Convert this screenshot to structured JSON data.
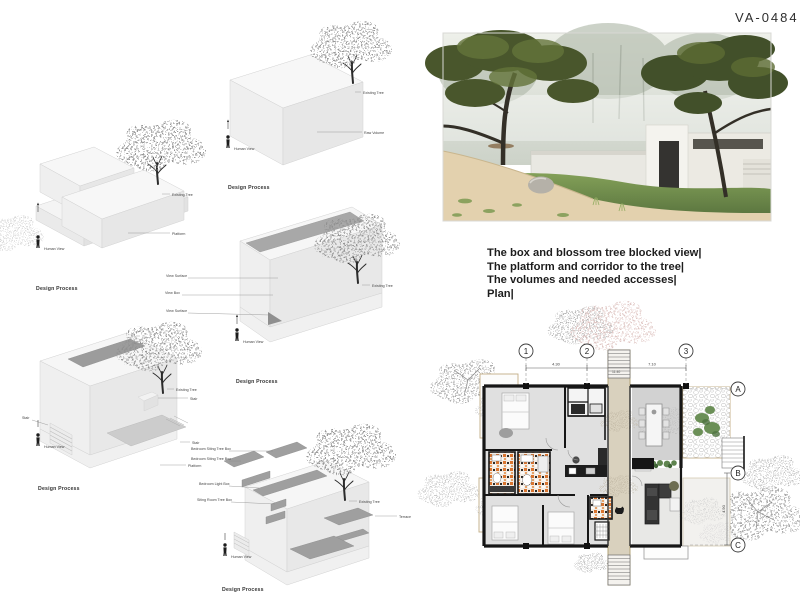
{
  "board": {
    "code": "VA-0484"
  },
  "description": {
    "line1": "The box and blossom tree blocked view|",
    "line2": "The platform and corridor to the tree|",
    "line3": "The volumes and needed accesses|",
    "line4": "Plan|"
  },
  "diagrams": {
    "caption": "Design Process",
    "d1": {
      "labels": {
        "existing_tree": "Existing Tree",
        "raw_volume": "Raw Volume",
        "human_view": "Human View"
      }
    },
    "d2": {
      "labels": {
        "existing_tree": "Existing Tree",
        "platform": "Platform",
        "human_view": "Human View"
      }
    },
    "d3": {
      "labels": {
        "view_surface_top": "View Surface",
        "view_box": "View Box",
        "view_surface_bottom": "View Surface",
        "existing_tree": "Existing Tree",
        "human_view": "Human View"
      }
    },
    "d4": {
      "labels": {
        "stair_left": "Stair",
        "stair_top": "Stair",
        "stair_right": "Stair",
        "platform": "Platform",
        "existing_tree": "Existing Tree",
        "human_view": "Human View"
      }
    },
    "d5": {
      "labels": {
        "bedroom_tree_box_1": "Bedroom Siting Tree Box",
        "bedroom_tree_box_2": "Bedroom Siting Tree Box",
        "bedroom_light_box": "Bedroom Light Box",
        "siting_room_tree_box": "Siting Room Tree Box",
        "terrace": "Terrace",
        "existing_tree": "Existing Tree",
        "human_view": "Human View"
      }
    }
  },
  "plan": {
    "grid_cols": [
      "1",
      "2",
      "3"
    ],
    "grid_rows": [
      "A",
      "B",
      "C"
    ],
    "dims": {
      "d12": "4.30",
      "d23": "7.10",
      "total": "11.40",
      "bc": "4.90"
    }
  }
}
